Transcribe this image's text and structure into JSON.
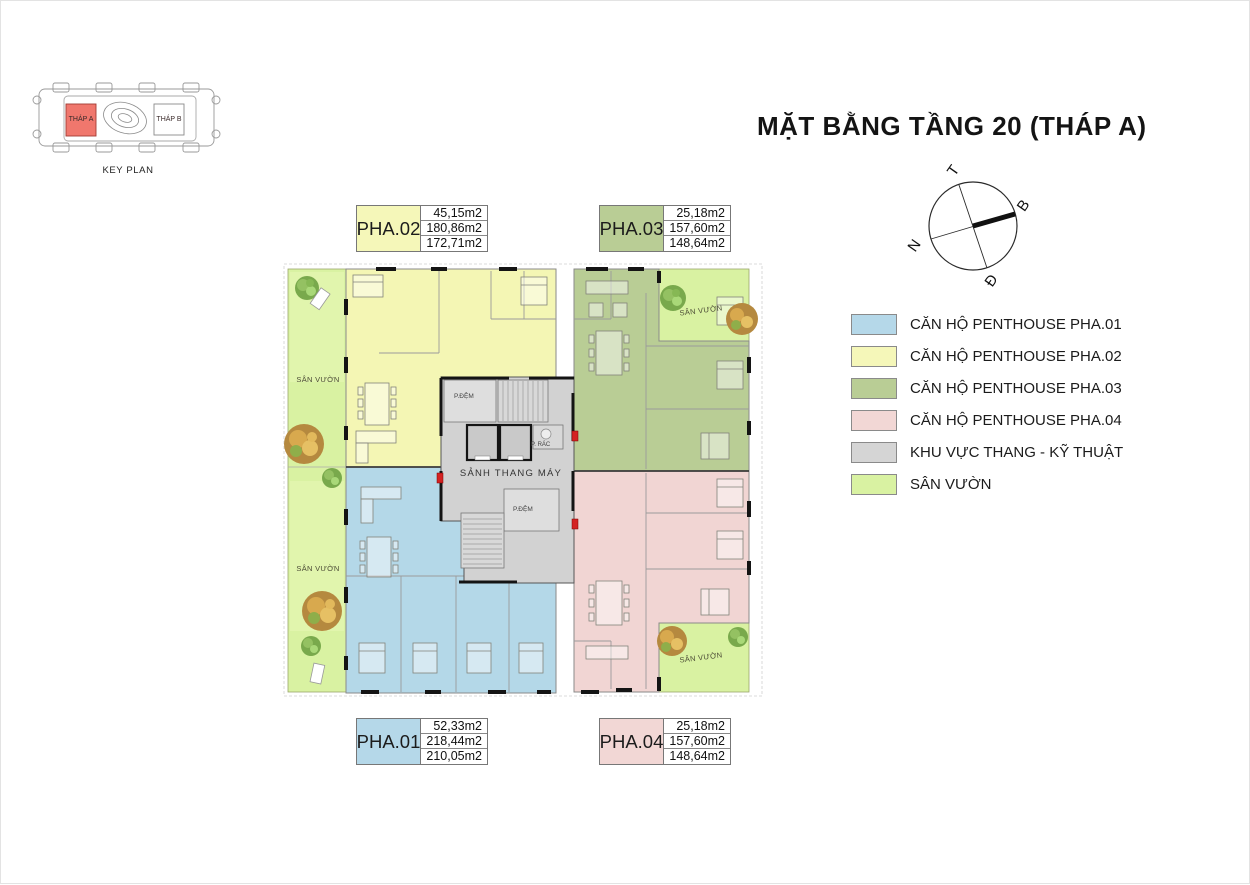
{
  "title": "MẶT BẰNG TẦNG 20 (THÁP A)",
  "key_plan": {
    "caption": "KEY PLAN",
    "tower_a": "THÁP A",
    "tower_b": "THÁP B"
  },
  "compass": {
    "west": "T",
    "north": "B",
    "south": "N",
    "east": "Đ"
  },
  "legend": {
    "items": [
      {
        "label": "CĂN HỘ PENTHOUSE PHA.01",
        "color": "#b5d8e9"
      },
      {
        "label": "CĂN HỘ PENTHOUSE PHA.02",
        "color": "#f5f7b9"
      },
      {
        "label": "CĂN HỘ PENTHOUSE PHA.03",
        "color": "#b9cd95"
      },
      {
        "label": "CĂN HỘ PENTHOUSE PHA.04",
        "color": "#f2d7d5"
      },
      {
        "label": "KHU VỰC THANG - KỸ THUẬT",
        "color": "#d5d5d5"
      },
      {
        "label": "SÂN VƯỜN",
        "color": "#d9f2a2"
      }
    ]
  },
  "tables": {
    "pha02": {
      "id": "PHA.02",
      "color": "#f5f7b9",
      "areas": [
        "45,15m2",
        "180,86m2",
        "172,71m2"
      ]
    },
    "pha03": {
      "id": "PHA.03",
      "color": "#b9cd95",
      "areas": [
        "25,18m2",
        "157,60m2",
        "148,64m2"
      ]
    },
    "pha01": {
      "id": "PHA.01",
      "color": "#b5d8e9",
      "areas": [
        "52,33m2",
        "218,44m2",
        "210,05m2"
      ]
    },
    "pha04": {
      "id": "PHA.04",
      "color": "#f2d7d5",
      "areas": [
        "25,18m2",
        "157,60m2",
        "148,64m2"
      ]
    }
  },
  "plan_labels": {
    "lobby": "SẢNH THANG MÁY",
    "buffer_room": "P.ĐỆM",
    "trash_room": "P. RÁC",
    "garden": "SÂN VƯỜN"
  }
}
